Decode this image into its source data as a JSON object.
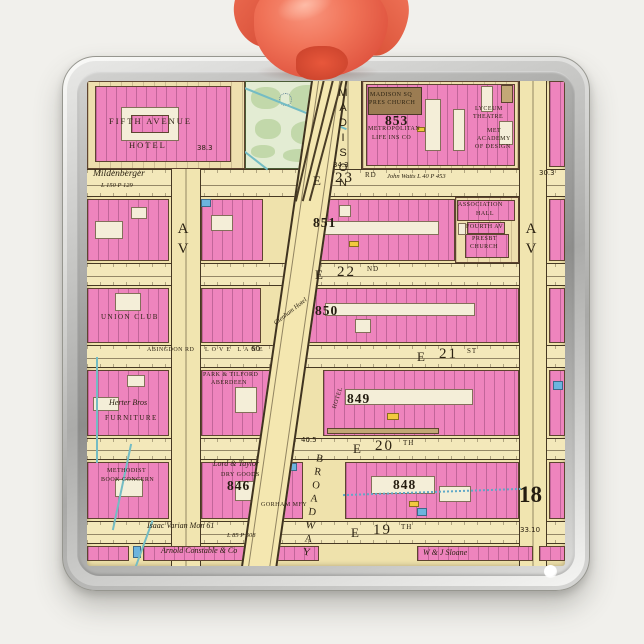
{
  "scene": {
    "background": "#f1f0ec"
  },
  "ornament": {
    "frame_color": "#c9c9c7",
    "ribbon_color": "#ee6a50"
  },
  "map": {
    "palette": {
      "paper": "#efe2ac",
      "street": "#f3e8ba",
      "building_pink": "#ee84bd",
      "building_white": "#f4eed8",
      "church_brown": "#9b7c52",
      "park_green": "#e3ecd3",
      "water_blue": "#74bcc4",
      "accent_blue": "#6cb4de",
      "accent_yellow": "#f2c93e"
    },
    "rects": [
      {
        "c": "hst",
        "x": 0,
        "y": 88,
        "w": 478,
        "h": 28
      },
      {
        "c": "hst",
        "x": 0,
        "y": 182,
        "w": 478,
        "h": 23
      },
      {
        "c": "hst",
        "x": 0,
        "y": 264,
        "w": 478,
        "h": 23
      },
      {
        "c": "hst",
        "x": 0,
        "y": 357,
        "w": 478,
        "h": 22
      },
      {
        "c": "hst",
        "x": 0,
        "y": 440,
        "w": 478,
        "h": 23
      },
      {
        "c": "vav",
        "x": 84,
        "y": 0,
        "w": 30,
        "h": 485
      },
      {
        "c": "vav",
        "x": 432,
        "y": 0,
        "w": 28,
        "h": 485
      },
      {
        "c": "vav",
        "x": 247,
        "y": 0,
        "w": 28,
        "h": 88
      },
      {
        "c": "park",
        "x": 158,
        "y": 0,
        "w": 89,
        "h": 88
      },
      {
        "c": "gn",
        "x": 164,
        "y": 6,
        "w": 30,
        "h": 22
      },
      {
        "c": "gn",
        "x": 202,
        "y": 4,
        "w": 38,
        "h": 26
      },
      {
        "c": "gn",
        "x": 168,
        "y": 38,
        "w": 26,
        "h": 20
      },
      {
        "c": "gn",
        "x": 204,
        "y": 40,
        "w": 36,
        "h": 24
      },
      {
        "c": "gn",
        "x": 196,
        "y": 68,
        "w": 34,
        "h": 13
      },
      {
        "c": "gn",
        "x": 164,
        "y": 64,
        "w": 24,
        "h": 13
      },
      {
        "c": "fount",
        "x": 192,
        "y": 12,
        "w": 13,
        "h": 13
      },
      {
        "c": "stream",
        "x": 140,
        "y": 24,
        "w": 124,
        "h": 2,
        "r": 22
      },
      {
        "c": "stream",
        "x": 118,
        "y": 66,
        "w": 70,
        "h": 2,
        "r": 38
      },
      {
        "c": "lot",
        "x": 0,
        "y": 0,
        "w": 158,
        "h": 88
      },
      {
        "c": "pk",
        "x": 8,
        "y": 5,
        "w": 136,
        "h": 76
      },
      {
        "c": "wt",
        "x": 34,
        "y": 26,
        "w": 58,
        "h": 34
      },
      {
        "c": "pk",
        "x": 44,
        "y": 34,
        "w": 38,
        "h": 18
      },
      {
        "c": "lot",
        "x": 275,
        "y": 0,
        "w": 157,
        "h": 88
      },
      {
        "c": "pk",
        "x": 279,
        "y": 3,
        "w": 149,
        "h": 82
      },
      {
        "c": "bn2",
        "x": 281,
        "y": 6,
        "w": 54,
        "h": 28
      },
      {
        "c": "wt",
        "x": 338,
        "y": 18,
        "w": 16,
        "h": 52
      },
      {
        "c": "wt",
        "x": 366,
        "y": 28,
        "w": 12,
        "h": 42
      },
      {
        "c": "wt",
        "x": 394,
        "y": 5,
        "w": 12,
        "h": 26
      },
      {
        "c": "wt",
        "x": 412,
        "y": 40,
        "w": 14,
        "h": 24
      },
      {
        "c": "tn",
        "x": 414,
        "y": 4,
        "w": 12,
        "h": 18
      },
      {
        "c": "pk",
        "x": 462,
        "y": 0,
        "w": 16,
        "h": 86
      },
      {
        "c": "pk",
        "x": 0,
        "y": 118,
        "w": 82,
        "h": 62
      },
      {
        "c": "wt",
        "x": 8,
        "y": 140,
        "w": 28,
        "h": 18
      },
      {
        "c": "wt",
        "x": 44,
        "y": 126,
        "w": 16,
        "h": 12
      },
      {
        "c": "pk",
        "x": 114,
        "y": 118,
        "w": 62,
        "h": 62
      },
      {
        "c": "wt",
        "x": 124,
        "y": 134,
        "w": 22,
        "h": 16
      },
      {
        "c": "pk",
        "x": 210,
        "y": 118,
        "w": 158,
        "h": 62
      },
      {
        "c": "wt",
        "x": 228,
        "y": 140,
        "w": 124,
        "h": 14
      },
      {
        "c": "wt",
        "x": 252,
        "y": 124,
        "w": 12,
        "h": 12
      },
      {
        "c": "lot",
        "x": 368,
        "y": 116,
        "w": 64,
        "h": 66
      },
      {
        "c": "pk",
        "x": 370,
        "y": 119,
        "w": 58,
        "h": 21
      },
      {
        "c": "pk",
        "x": 380,
        "y": 141,
        "w": 38,
        "h": 12
      },
      {
        "c": "pk",
        "x": 378,
        "y": 153,
        "w": 44,
        "h": 24
      },
      {
        "c": "wt",
        "x": 371,
        "y": 142,
        "w": 8,
        "h": 12
      },
      {
        "c": "pk",
        "x": 462,
        "y": 118,
        "w": 16,
        "h": 62
      },
      {
        "c": "bl",
        "x": 114,
        "y": 118,
        "w": 10,
        "h": 8
      },
      {
        "c": "yl",
        "x": 262,
        "y": 160,
        "w": 10,
        "h": 6
      },
      {
        "c": "yl",
        "x": 330,
        "y": 46,
        "w": 8,
        "h": 5
      },
      {
        "c": "pk",
        "x": 0,
        "y": 207,
        "w": 82,
        "h": 55
      },
      {
        "c": "wt",
        "x": 28,
        "y": 212,
        "w": 26,
        "h": 18
      },
      {
        "c": "pk",
        "x": 114,
        "y": 207,
        "w": 60,
        "h": 55
      },
      {
        "c": "pk",
        "x": 218,
        "y": 207,
        "w": 214,
        "h": 55
      },
      {
        "c": "wt",
        "x": 238,
        "y": 222,
        "w": 150,
        "h": 13
      },
      {
        "c": "wt",
        "x": 268,
        "y": 238,
        "w": 16,
        "h": 14
      },
      {
        "c": "pk",
        "x": 462,
        "y": 207,
        "w": 16,
        "h": 55
      },
      {
        "c": "pk",
        "x": 0,
        "y": 289,
        "w": 82,
        "h": 66
      },
      {
        "c": "wt",
        "x": 6,
        "y": 316,
        "w": 26,
        "h": 14
      },
      {
        "c": "wt",
        "x": 40,
        "y": 294,
        "w": 18,
        "h": 12
      },
      {
        "c": "pk",
        "x": 114,
        "y": 289,
        "w": 84,
        "h": 66
      },
      {
        "c": "wt",
        "x": 148,
        "y": 306,
        "w": 22,
        "h": 26
      },
      {
        "c": "pk",
        "x": 236,
        "y": 289,
        "w": 196,
        "h": 66
      },
      {
        "c": "wt",
        "x": 258,
        "y": 308,
        "w": 128,
        "h": 16
      },
      {
        "c": "tn",
        "x": 240,
        "y": 347,
        "w": 112,
        "h": 6
      },
      {
        "c": "yl",
        "x": 300,
        "y": 332,
        "w": 12,
        "h": 7
      },
      {
        "c": "pk",
        "x": 462,
        "y": 289,
        "w": 16,
        "h": 66
      },
      {
        "c": "bl",
        "x": 466,
        "y": 300,
        "w": 10,
        "h": 9
      },
      {
        "c": "pk",
        "x": 0,
        "y": 381,
        "w": 82,
        "h": 57
      },
      {
        "c": "wt",
        "x": 28,
        "y": 398,
        "w": 28,
        "h": 18
      },
      {
        "c": "pk",
        "x": 114,
        "y": 381,
        "w": 102,
        "h": 57
      },
      {
        "c": "wt",
        "x": 148,
        "y": 400,
        "w": 24,
        "h": 20
      },
      {
        "c": "bl",
        "x": 196,
        "y": 382,
        "w": 14,
        "h": 8
      },
      {
        "c": "pk",
        "x": 258,
        "y": 381,
        "w": 174,
        "h": 57
      },
      {
        "c": "wt",
        "x": 284,
        "y": 395,
        "w": 64,
        "h": 18
      },
      {
        "c": "wt",
        "x": 352,
        "y": 405,
        "w": 32,
        "h": 16
      },
      {
        "c": "yl",
        "x": 322,
        "y": 420,
        "w": 10,
        "h": 6
      },
      {
        "c": "bl",
        "x": 330,
        "y": 427,
        "w": 10,
        "h": 8
      },
      {
        "c": "pk",
        "x": 462,
        "y": 381,
        "w": 16,
        "h": 57
      },
      {
        "c": "pk",
        "x": 0,
        "y": 465,
        "w": 42,
        "h": 15
      },
      {
        "c": "pk",
        "x": 56,
        "y": 465,
        "w": 176,
        "h": 15
      },
      {
        "c": "pk",
        "x": 330,
        "y": 465,
        "w": 116,
        "h": 15
      },
      {
        "c": "pk",
        "x": 452,
        "y": 465,
        "w": 26,
        "h": 15
      },
      {
        "c": "bl",
        "x": 46,
        "y": 465,
        "w": 8,
        "h": 12
      },
      {
        "c": "stream",
        "x": 9,
        "y": 276,
        "w": 2,
        "h": 106
      },
      {
        "c": "stream",
        "x": 34,
        "y": 362,
        "w": 2,
        "h": 88,
        "r": 12
      },
      {
        "c": "stream",
        "x": 56,
        "y": 438,
        "w": 2,
        "h": 50,
        "r": 20
      },
      {
        "c": "dotline",
        "x": 256,
        "y": 410,
        "w": 178,
        "h": 2,
        "r": -2
      },
      {
        "c": "bway",
        "x": 189,
        "y": -18,
        "w": 36,
        "h": 524,
        "r": 8.2
      },
      {
        "c": "trk",
        "x": 222,
        "y": -4,
        "w": 2,
        "h": 126,
        "r": 13
      },
      {
        "c": "trk",
        "x": 230,
        "y": -4,
        "w": 2,
        "h": 126,
        "r": 14
      },
      {
        "c": "trk",
        "x": 238,
        "y": -4,
        "w": 2,
        "h": 126,
        "r": 15
      }
    ],
    "labels": [
      {
        "t": "Mildenberger",
        "x": 6,
        "y": 89,
        "c": "it9"
      },
      {
        "t": "L 150 P 129",
        "x": 14,
        "y": 102,
        "c": "it65"
      },
      {
        "t": "E",
        "x": 226,
        "y": 93,
        "c": "stE"
      },
      {
        "t": "23",
        "x": 248,
        "y": 90,
        "c": "stN"
      },
      {
        "t": "RD",
        "x": 278,
        "y": 91,
        "c": "stS"
      },
      {
        "t": "John Watts L 40 P 453",
        "x": 300,
        "y": 93,
        "c": "it65"
      },
      {
        "t": "34.3",
        "x": 246,
        "y": 81,
        "c": "meas"
      },
      {
        "t": "30.3",
        "x": 452,
        "y": 89,
        "c": "meas"
      },
      {
        "t": "38.3",
        "x": 110,
        "y": 64,
        "c": "meas"
      },
      {
        "t": "FIFTH AVENUE",
        "x": 22,
        "y": 36,
        "c": "cap8"
      },
      {
        "t": "HOTEL",
        "x": 42,
        "y": 60,
        "c": "cap8"
      },
      {
        "t": "MADISON SQ",
        "x": 283,
        "y": 11,
        "c": "cap"
      },
      {
        "t": "PRES CHURCH",
        "x": 282,
        "y": 19,
        "c": "cap"
      },
      {
        "t": "METROPOLITAN",
        "x": 281,
        "y": 45,
        "c": "cap"
      },
      {
        "t": "LIFE INS CO",
        "x": 285,
        "y": 54,
        "c": "cap"
      },
      {
        "t": "853",
        "x": 298,
        "y": 33,
        "c": "bn"
      },
      {
        "t": "LYCEUM",
        "x": 388,
        "y": 25,
        "c": "cap"
      },
      {
        "t": "THEATRE",
        "x": 386,
        "y": 33,
        "c": "cap"
      },
      {
        "t": "MET",
        "x": 400,
        "y": 47,
        "c": "cap"
      },
      {
        "t": "ACADEMY",
        "x": 390,
        "y": 55,
        "c": "cap"
      },
      {
        "t": "OF DESIGN",
        "x": 388,
        "y": 63,
        "c": "cap"
      },
      {
        "t": "MADISON",
        "x": 250,
        "y": 6,
        "c": "vtext mad"
      },
      {
        "t": "AV",
        "x": 88,
        "y": 140,
        "c": "vtext av"
      },
      {
        "t": "AV",
        "x": 436,
        "y": 140,
        "c": "vtext av"
      },
      {
        "t": "851",
        "x": 226,
        "y": 135,
        "c": "bn"
      },
      {
        "t": "ASSOCIATION",
        "x": 371,
        "y": 121,
        "c": "cap"
      },
      {
        "t": "HALL",
        "x": 389,
        "y": 130,
        "c": "cap"
      },
      {
        "t": "FOURTH AV",
        "x": 379,
        "y": 143,
        "c": "cap"
      },
      {
        "t": "PRESBT",
        "x": 385,
        "y": 155,
        "c": "cap"
      },
      {
        "t": "CHURCH",
        "x": 383,
        "y": 163,
        "c": "cap"
      },
      {
        "t": "E",
        "x": 228,
        "y": 187,
        "c": "stE"
      },
      {
        "t": "22",
        "x": 250,
        "y": 184,
        "c": "stN"
      },
      {
        "t": "ND",
        "x": 280,
        "y": 185,
        "c": "stS"
      },
      {
        "t": "UNION CLUB",
        "x": 14,
        "y": 233,
        "c": "cap7"
      },
      {
        "t": "850",
        "x": 228,
        "y": 223,
        "c": "bn"
      },
      {
        "t": "Glenham Hotel",
        "x": 184,
        "y": 228,
        "c": "it65",
        "r": -38
      },
      {
        "t": "ABINGDON RD",
        "x": 60,
        "y": 266,
        "c": "cap"
      },
      {
        "t": "LOVE LANE",
        "x": 118,
        "y": 266,
        "c": "cap sp"
      },
      {
        "t": "60",
        "x": 164,
        "y": 265,
        "c": "meas"
      },
      {
        "t": "E",
        "x": 330,
        "y": 269,
        "c": "stE"
      },
      {
        "t": "21",
        "x": 352,
        "y": 266,
        "c": "stN"
      },
      {
        "t": "ST",
        "x": 380,
        "y": 267,
        "c": "stS"
      },
      {
        "t": "PARK & TILFORD",
        "x": 116,
        "y": 291,
        "c": "cap"
      },
      {
        "t": "ABERDEEN",
        "x": 124,
        "y": 299,
        "c": "cap"
      },
      {
        "t": "849",
        "x": 260,
        "y": 311,
        "c": "bn"
      },
      {
        "t": "HOTEL",
        "x": 240,
        "y": 314,
        "c": "cap",
        "r": -72
      },
      {
        "t": "Herter Bros",
        "x": 22,
        "y": 318,
        "c": "it"
      },
      {
        "t": "FURNITURE",
        "x": 18,
        "y": 334,
        "c": "cap7"
      },
      {
        "t": "E",
        "x": 266,
        "y": 361,
        "c": "stE"
      },
      {
        "t": "20",
        "x": 288,
        "y": 358,
        "c": "stN"
      },
      {
        "t": "TH",
        "x": 316,
        "y": 359,
        "c": "stS"
      },
      {
        "t": "40.5",
        "x": 214,
        "y": 356,
        "c": "meas"
      },
      {
        "t": "METHODIST",
        "x": 20,
        "y": 387,
        "c": "cap"
      },
      {
        "t": "BOOK CONCERN",
        "x": 14,
        "y": 396,
        "c": "cap"
      },
      {
        "t": "Lord & Taylor",
        "x": 126,
        "y": 379,
        "c": "it"
      },
      {
        "t": "DRY GOODS",
        "x": 134,
        "y": 391,
        "c": "cap"
      },
      {
        "t": "846",
        "x": 140,
        "y": 398,
        "c": "bn"
      },
      {
        "t": "GORHAM MFY",
        "x": 174,
        "y": 421,
        "c": "cap"
      },
      {
        "t": "848",
        "x": 306,
        "y": 397,
        "c": "bn"
      },
      {
        "t": "BROADWAY",
        "x": 220,
        "y": 372,
        "c": "vtext bwy",
        "r": 8
      },
      {
        "t": "18",
        "x": 432,
        "y": 402,
        "c": "plate"
      },
      {
        "t": "33.10",
        "x": 433,
        "y": 446,
        "c": "meas"
      },
      {
        "t": "Isaac Varian Mon 61",
        "x": 60,
        "y": 441,
        "c": "it"
      },
      {
        "t": "L 85 P 308",
        "x": 140,
        "y": 452,
        "c": "it65"
      },
      {
        "t": "E",
        "x": 264,
        "y": 445,
        "c": "stE"
      },
      {
        "t": "19",
        "x": 286,
        "y": 442,
        "c": "stN"
      },
      {
        "t": "TH",
        "x": 314,
        "y": 443,
        "c": "stS"
      },
      {
        "t": "Arnold Constable & Co",
        "x": 74,
        "y": 466,
        "c": "it"
      },
      {
        "t": "W & J Sloane",
        "x": 336,
        "y": 468,
        "c": "it"
      }
    ]
  }
}
